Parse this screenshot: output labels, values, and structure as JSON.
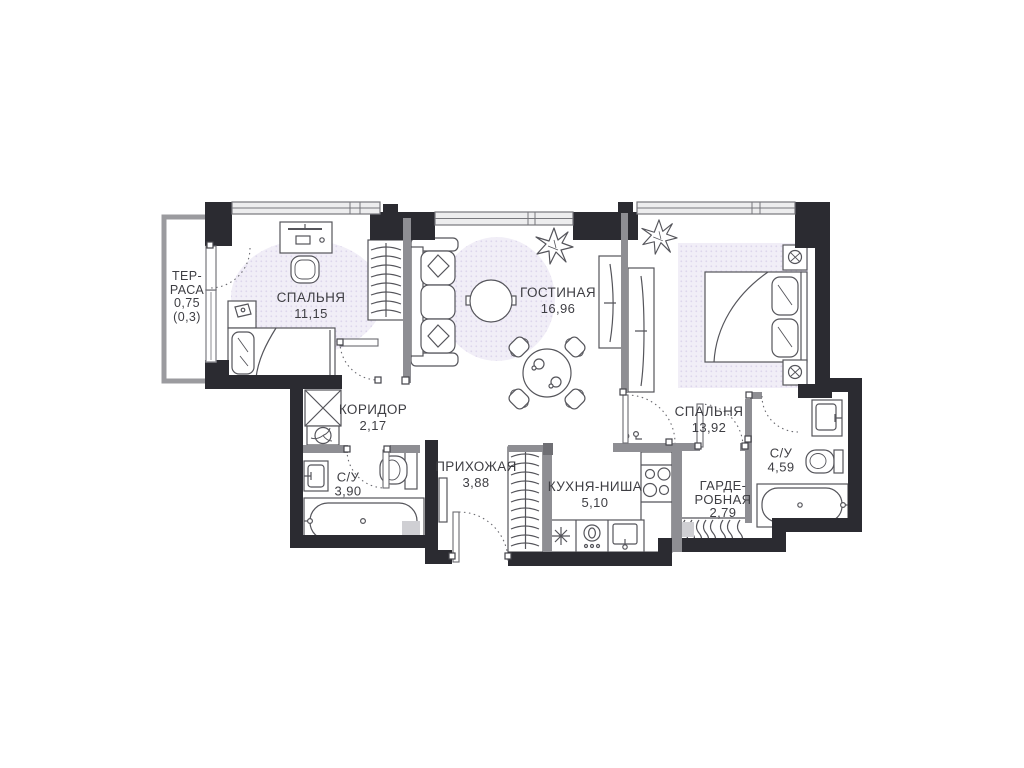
{
  "plan_type": "apartment-floor-plan",
  "colors": {
    "wall": "#2b2b31",
    "partition": "#8e8e93",
    "furniture_stroke": "#55555b",
    "shading_fill": "#f1eef7",
    "shading_dot": "#ddd5ec",
    "shaft_fill": "#cfcfd3",
    "text": "#3e3e43",
    "window_fill": "#ededee"
  },
  "rooms": {
    "terrace": {
      "name_line1": "ТЕР-",
      "name_line2": "РАСА",
      "area": "0,75",
      "area_secondary": "(0,3)"
    },
    "bedroom1": {
      "name": "СПАЛЬНЯ",
      "area": "11,15"
    },
    "living": {
      "name": "ГОСТИНАЯ",
      "area": "16,96"
    },
    "bedroom2": {
      "name": "СПАЛЬНЯ",
      "area": "13,92"
    },
    "corridor": {
      "name": "КОРИДОР",
      "area": "2,17"
    },
    "bathroom1": {
      "name": "С/У",
      "area": "3,90"
    },
    "hallway": {
      "name": "ПРИХОЖАЯ",
      "area": "3,88"
    },
    "kitchen": {
      "name": "КУХНЯ-НИША",
      "area": "5,10"
    },
    "wardrobe": {
      "name_line1": "ГАРДЕ-",
      "name_line2": "РОБНАЯ",
      "area": "2,79"
    },
    "bathroom2": {
      "name": "С/У",
      "area": "4,59"
    }
  }
}
